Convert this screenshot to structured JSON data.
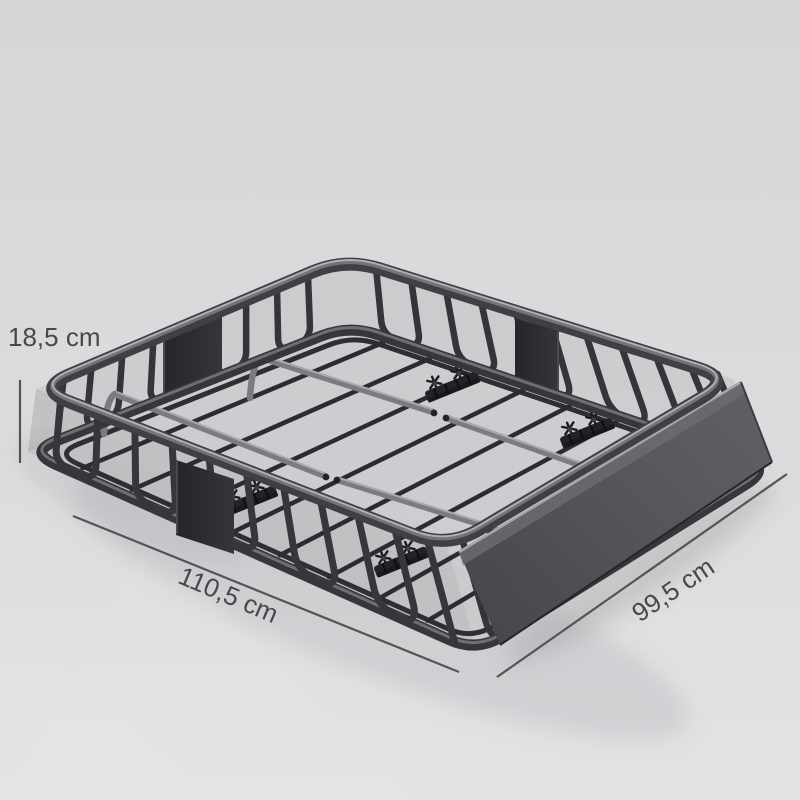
{
  "scene": {
    "subject": "roof cargo basket product render",
    "background_color": "#dcdcde"
  },
  "dimensions": {
    "height_label": "18,5 cm",
    "length_label": "110,5 cm",
    "width_label": "99,5 cm"
  },
  "colors": {
    "metal_dark": "#36363b",
    "metal_highlight": "#a9a9b0",
    "crossbar_metal": "#7b7b82",
    "fairing_panel": "#54545a",
    "mount_plate": "#2c2c31",
    "dimension_text": "#48484b",
    "dimension_line": "#545457"
  }
}
